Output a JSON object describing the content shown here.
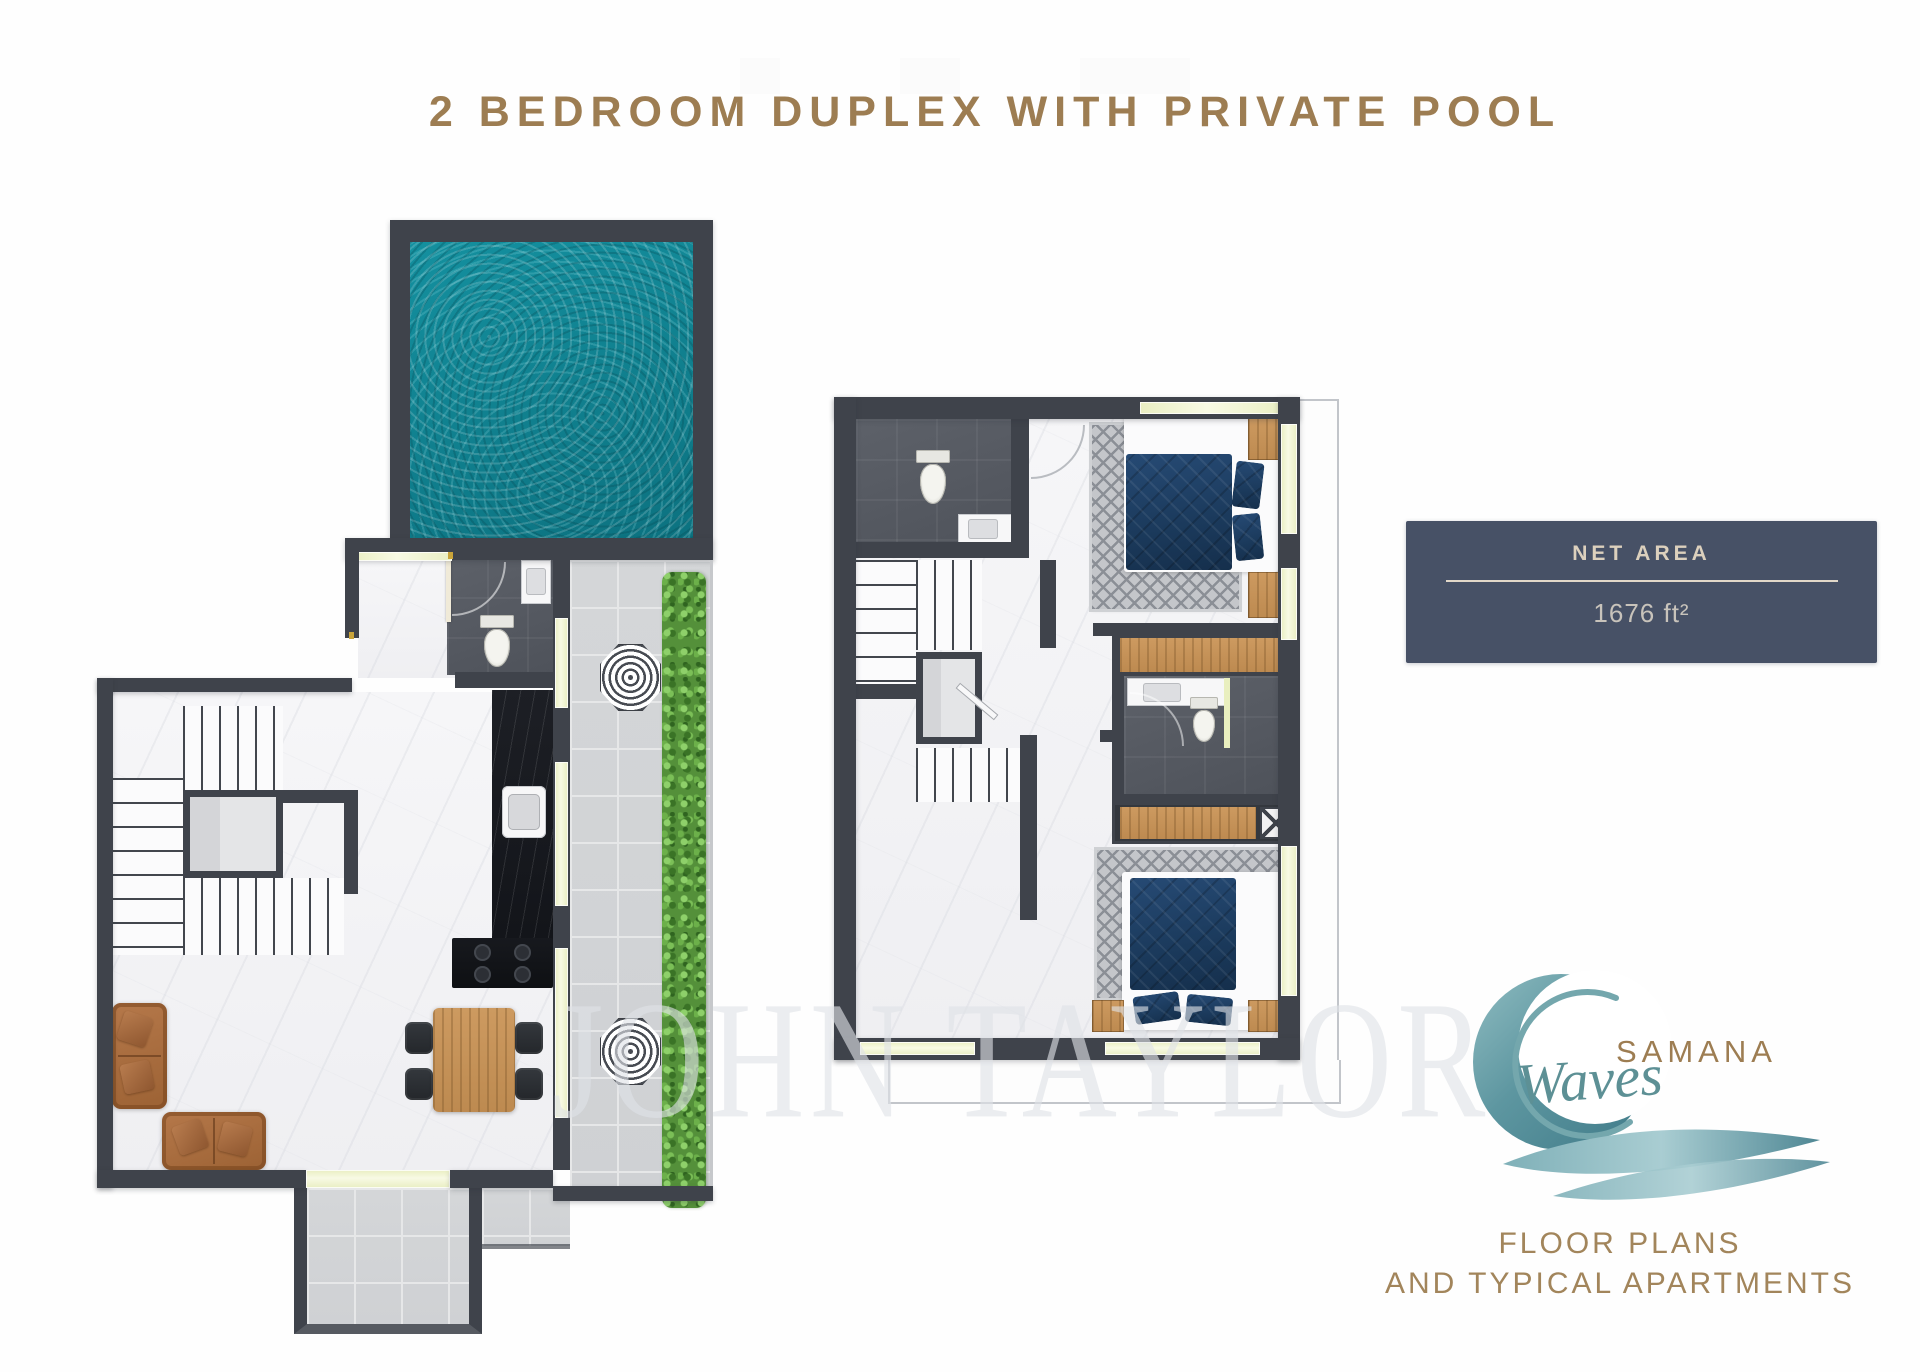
{
  "title": "2 BEDROOM DUPLEX WITH PRIVATE POOL",
  "net_area": {
    "label": "NET AREA",
    "value": "1676 ft²"
  },
  "brand": {
    "name": "SAMANA",
    "script": "Waves"
  },
  "footer": {
    "line1": "FLOOR PLANS",
    "line2": "AND TYPICAL APARTMENTS"
  },
  "watermark": "JOHN TAYLOR",
  "colors": {
    "accent_gold": "#9d7d52",
    "badge_bg": "#475166",
    "badge_text": "#dcd0bd",
    "wall": "#3f434b",
    "pool_teal": "#0e8190",
    "hedge_green": "#54903a",
    "wood": "#c6935a",
    "bed_navy": "#1b3a5c",
    "logo_teal": "#5d9095"
  }
}
